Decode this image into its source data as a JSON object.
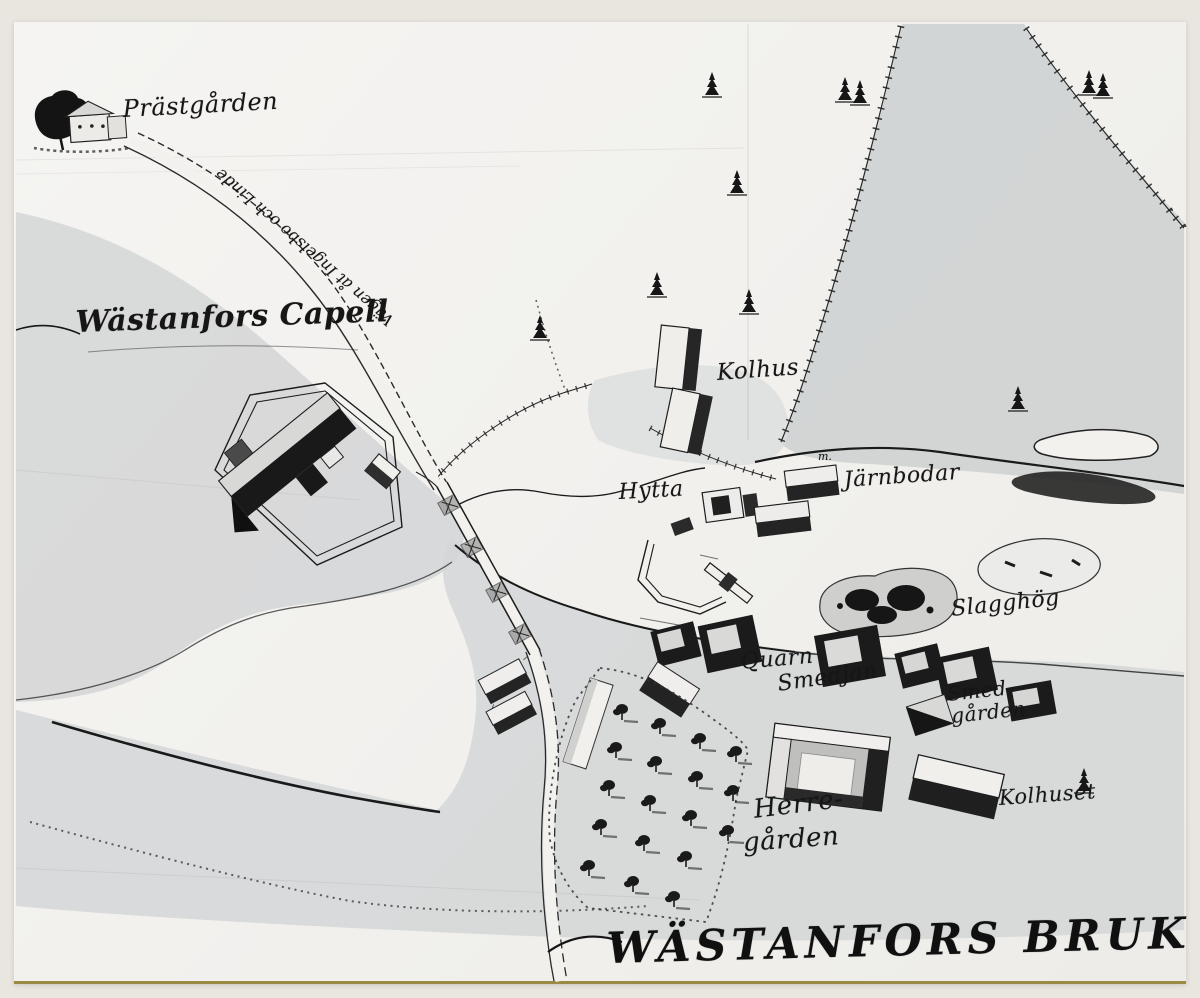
{
  "document": {
    "kind": "photograph of an 18th-century hand-drawn Swedish ironworks map",
    "place_title": "WÄSTANFORS BRUK"
  },
  "labels": {
    "prastgarden": "Prästgården",
    "road": "Vägen åt Ingelsbo och Linde",
    "capell": "Wästanfors Capell",
    "kolhus": "Kolhus",
    "hytta": "Hytta",
    "jarnbodar_note": "m.",
    "jarnbodar": "Järnbodar",
    "slagghog": "Slagghög",
    "quarn": "Quarn",
    "smedjan": "Smedjan",
    "smedgarden_line1": "Smed-",
    "smedgarden_line2": "gården",
    "herregarden_line1": "Herre-",
    "herregarden_line2": "gården",
    "kolhuset": "Kolhuset",
    "title": "WÄSTANFORS BRUK"
  },
  "map_features": [
    "farmhouse with tree at Prästgården (top left)",
    "road with double dashed edges from Prästgården to bridge",
    "hexagonal churchyard wall with chapel building (Wästanfors Capell)",
    "river in white crossing the map with wooden bridge",
    "charcoal house (Kolhus) with fenced enclosures",
    "blast furnace area (Hytta) with sluice and water channels",
    "iron storehouses (Järnbodar)",
    "slag heap (Slagghög)",
    "mill (Quarn), forge (Smedjan), smith's yard (Smedgården)",
    "manor house (Herregården) with orchard of planted trees",
    "charcoal shed (Kolhuset)",
    "forest region with fence lines and spruce trees (top right)",
    "dotted property boundaries and shorelines (bottom left)"
  ],
  "colors": {
    "scan_margin": "#e9e6e0",
    "photo_paper": "#f2f1ee",
    "land_wash_gray": "#d3d5d6",
    "forest_wash_gray": "#ced1d2",
    "ink": "#1b1b1b",
    "photo_bottom_edge": "#9b8a44"
  }
}
